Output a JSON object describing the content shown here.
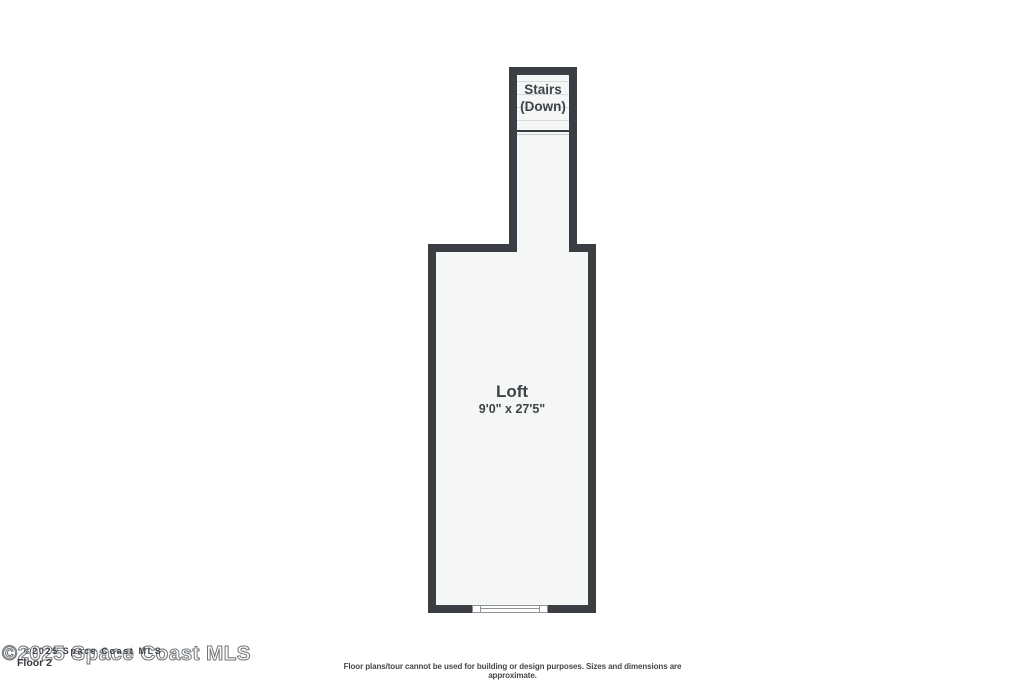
{
  "plan": {
    "stairs": {
      "label_line1": "Stairs",
      "label_line2": "(Down)"
    },
    "room": {
      "name": "Loft",
      "dimensions": "9'0\" x 27'5\""
    }
  },
  "footer": {
    "watermark_outline": "©2025 Space Coast MLS",
    "watermark_overlay": "©2025 Space Coast MLS",
    "floor_label": "Floor 2",
    "disclaimer": "Floor plans/tour cannot be used for building or design purposes. Sizes and dimensions are approximate."
  },
  "colors": {
    "wall": "#3b3e42",
    "floor_fill": "#f5f6f6",
    "label_text": "#3f4347",
    "tread_line": "#d7d9da",
    "window_line": "#8f9499"
  }
}
